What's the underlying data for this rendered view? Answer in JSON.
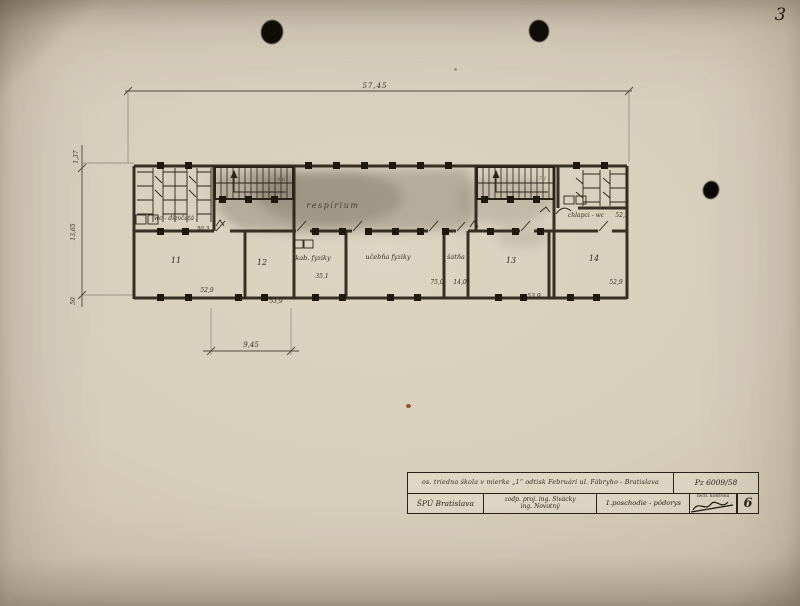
{
  "page_number": "3",
  "plan": {
    "dimensions": {
      "overall_width": "57,45",
      "bay_width": "9,45",
      "left_upper": "1,37",
      "left_main": "13,65",
      "left_lower": "50"
    },
    "corridor_label": "respírium",
    "wc_left_label": "wc - dievčatá",
    "wc_right_label": "chlapci - wc",
    "wc_right_area": "52,9",
    "door_dim": "50,3",
    "stair_left_note": "9,6",
    "stair_right_note": "17,1",
    "rooms": [
      {
        "label": "11",
        "area": "52,9"
      },
      {
        "label": "12",
        "area": "53,9"
      },
      {
        "label": "kab. fyziky",
        "area": "35,1"
      },
      {
        "label": "učebňa fyziky",
        "area": "75,0"
      },
      {
        "label": "šatňa",
        "area": "14,0"
      },
      {
        "label": "13",
        "area": "53,9"
      },
      {
        "label": "14",
        "area": "52,9"
      }
    ]
  },
  "title_block": {
    "project_title": "os. triedna škola v mierke „1“ odtisk Februári ul. Fábryho - Bratislava",
    "plan_number": "Pz 6009/58",
    "organization": "ŠPÚ Bratislava",
    "designer_line1": "zodp. proj. ing. Sivácky",
    "designer_line2": "ing. Novotný",
    "drawing_title": "1.poschodie - pôdorys",
    "check_label": "tech. kontrola",
    "sheet_number": "6"
  }
}
